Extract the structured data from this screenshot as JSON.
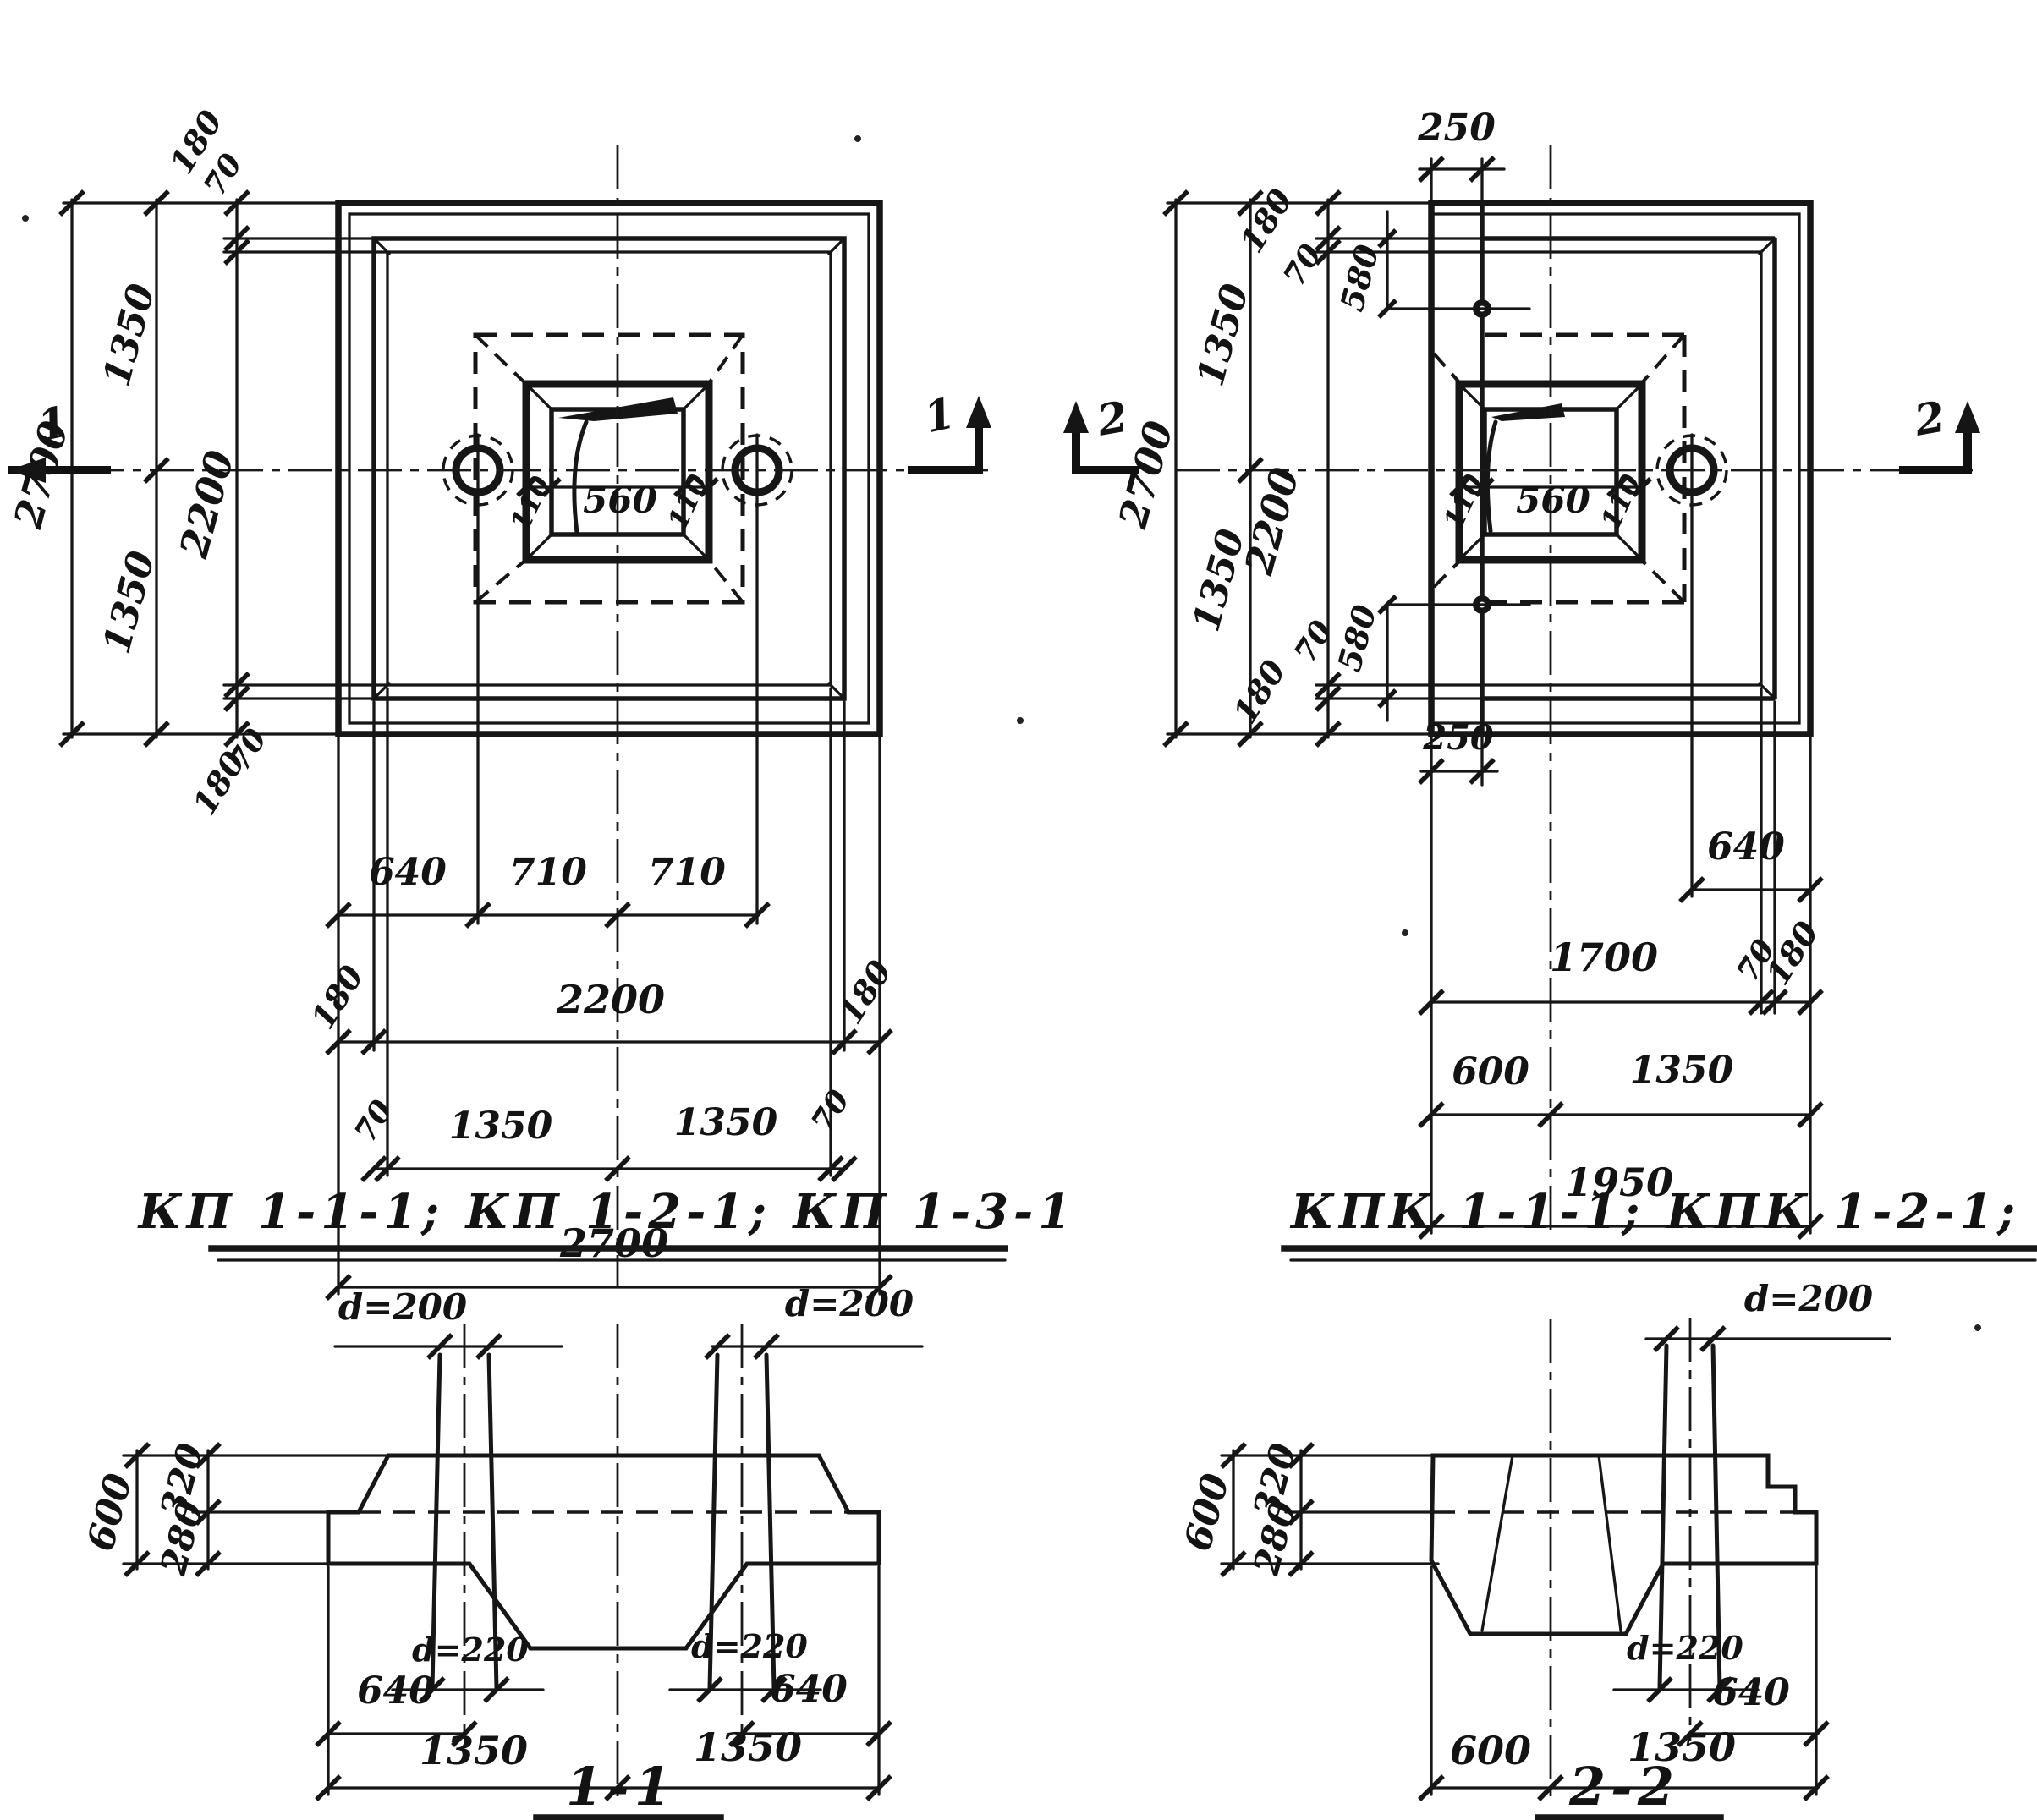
{
  "titles": {
    "plan_left": "КП 1-1-1; КП 1-2-1; КП 1-3-1",
    "plan_right": "КПК 1-1-1; КПК 1-2-1; КПК 1-3-1",
    "section_left": "1-1",
    "section_right": "2-2"
  },
  "section_markers": {
    "one": "1",
    "two": "2"
  },
  "plan_left": {
    "left_chain": {
      "v180_top": "180",
      "v70_top": "70",
      "v1350_top": "1350",
      "v2700": "2700",
      "v2200": "2200",
      "v1350_bot": "1350",
      "v70_bot": "70",
      "v180_bot": "180"
    },
    "socket": {
      "wall_left": "110",
      "opening": "560",
      "wall_right": "110"
    },
    "bottom_chain": {
      "row1": [
        "640",
        "710",
        "710"
      ],
      "row2": [
        "180",
        "2200",
        "180"
      ],
      "row3": [
        "70",
        "1350",
        "1350",
        "70"
      ],
      "row4": "2700"
    }
  },
  "plan_right": {
    "top_offset": "250",
    "bottom_offset": "250",
    "left_chain": {
      "v180_top": "180",
      "v70_top": "70",
      "v580_top": "580",
      "v1350_top": "1350",
      "v2700": "2700",
      "v2200": "2200",
      "v1350_bot": "1350",
      "v70_bot": "70",
      "v580_bot": "580",
      "v180_bot": "180"
    },
    "socket": {
      "wall_left": "110",
      "opening": "560",
      "wall_right": "110"
    },
    "bottom_chain": {
      "row1": "640",
      "row2": [
        "1700",
        "70",
        "180"
      ],
      "row3": [
        "600",
        "1350"
      ],
      "row4": "1950"
    }
  },
  "section_1_1": {
    "pipe_top_left": "d=200",
    "pipe_top_right": "d=200",
    "height_total": "600",
    "height_upper": "320",
    "height_lower": "280",
    "pipe_bottom_left": "d=220",
    "pipe_bottom_right": "d=220",
    "offset_left": "640",
    "offset_right": "640",
    "half_left": "1350",
    "half_right": "1350"
  },
  "section_2_2": {
    "pipe_top": "d=200",
    "height_total": "600",
    "height_upper": "320",
    "height_lower": "280",
    "pipe_bottom": "d=220",
    "offset": "640",
    "left_part": "600",
    "right_part": "1350"
  }
}
